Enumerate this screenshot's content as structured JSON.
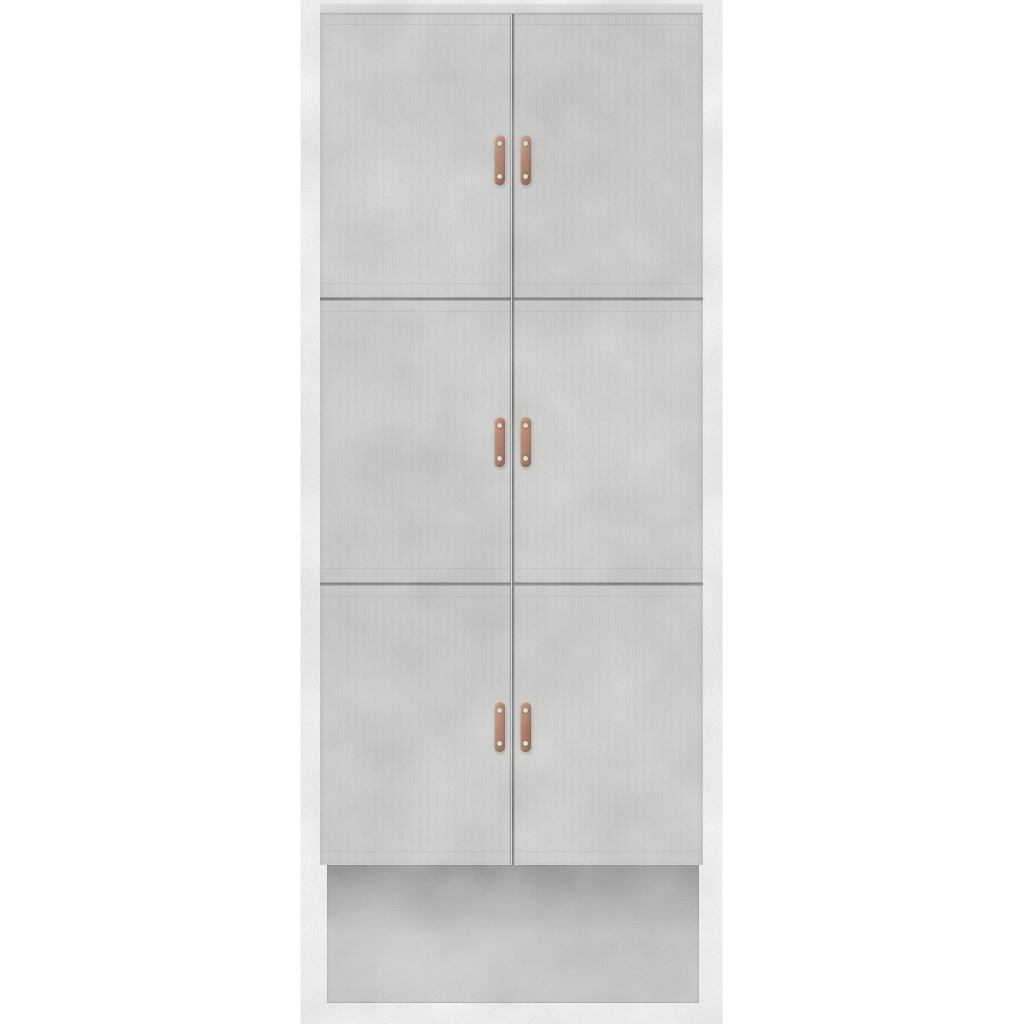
{
  "scene": {
    "description": "Product photograph of a tall concrete-grey highboard storage cabinet standing on a plinth base, shown front-on against a plain white background",
    "product": "Six-door highboard cabinet",
    "finish": "Concrete grey wood-effect",
    "door_rows": 3,
    "door_columns": 2,
    "door_count": 6,
    "handle_count": 6,
    "handle_style": "Vertical copper strap pulls with two screws each",
    "handle_screws_per_handle": 2,
    "base": "Recessed plinth with shadow beneath the doors"
  },
  "colors": {
    "background": "#ffffff",
    "concrete_base": "#cdcdcb",
    "concrete_light": "#dcdcda",
    "concrete_dark": "#c6c6c4",
    "top_edge": "#e6e6e4",
    "seam_line": "#525254",
    "plinth_shadow": "#8a8a88",
    "handle_copper_light": "#c5835f",
    "handle_copper_mid": "#a55f44",
    "handle_copper_dark": "#7c4430",
    "screw": "#f0e3cd"
  }
}
